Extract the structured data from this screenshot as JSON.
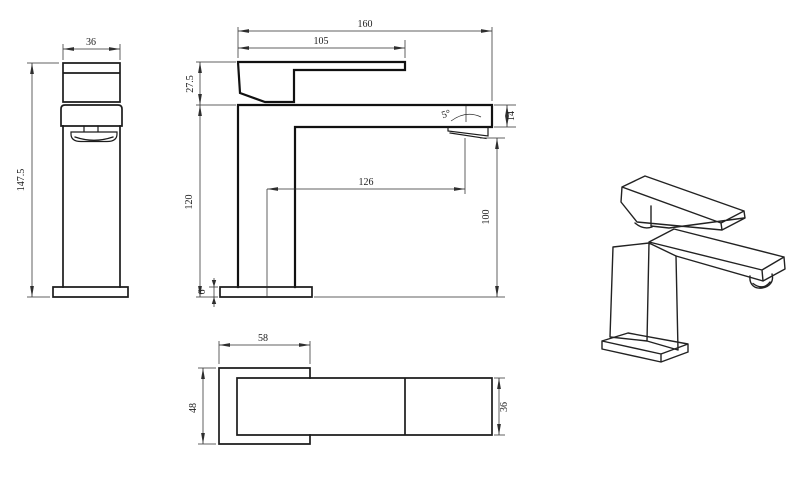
{
  "background": "#ffffff",
  "line_color": "#1c1c1c",
  "dim_color": "#2e2e2e",
  "views": {
    "side": {
      "width": "36",
      "height": "147.5"
    },
    "front": {
      "overall_length": "160",
      "handle_length": "105",
      "handle_height": "27.5",
      "body_height": "120",
      "spout_reach": "126",
      "outlet_height": "100",
      "spout_end_height": "14",
      "base_thickness": "6",
      "spout_angle": "5°"
    },
    "top": {
      "base_length": "58",
      "base_depth": "48",
      "spout_width": "36"
    }
  }
}
